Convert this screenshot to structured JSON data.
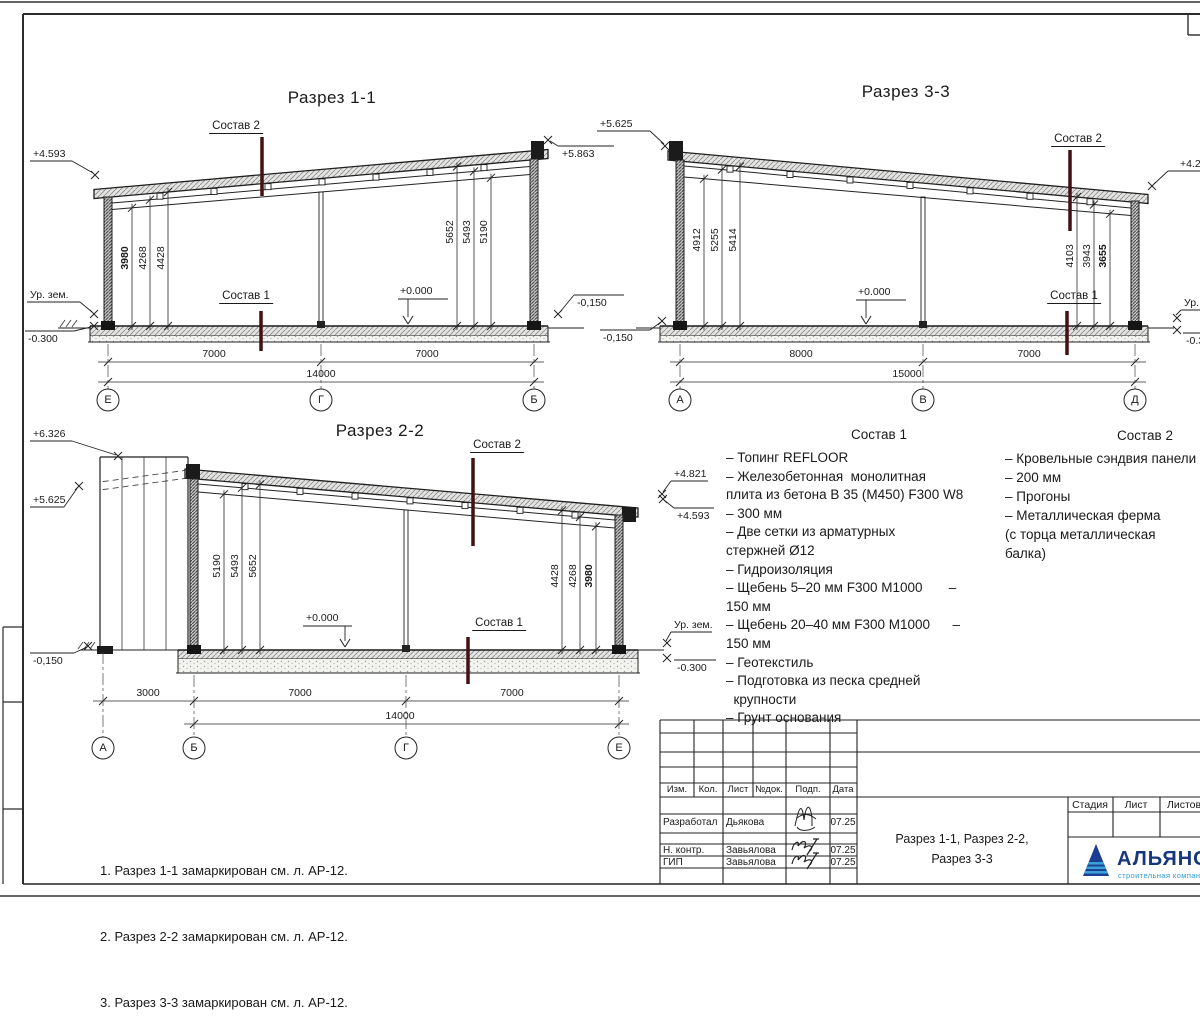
{
  "sections": {
    "s1": {
      "title": "Разрез 1-1",
      "sostav2": "Состав 2",
      "sostav1": "Состав 1",
      "elevs": {
        "left_top": "+4.593",
        "ground": "Ур. зем.",
        "left_bottom": "-0.300",
        "right_top": "+5.863",
        "right_bottom": "-0,150",
        "zero": "+0.000"
      },
      "dims_left": [
        "3980",
        "4268",
        "4428"
      ],
      "dims_right": [
        "5652",
        "5493",
        "5190"
      ],
      "spans": [
        "7000",
        "7000"
      ],
      "total": "14000",
      "axes": [
        "Е",
        "Г",
        "Б"
      ]
    },
    "s3": {
      "title": "Разрез 3-3",
      "sostav2": "Состав 2",
      "sostav1": "Состав 1",
      "elevs": {
        "left_top": "+5.625",
        "left_bottom": "-0,150",
        "right_top": "+4.2",
        "right_ground": "Ур.",
        "right_bottom": "-0.3",
        "zero": "+0.000"
      },
      "dims_left": [
        "4912",
        "5255",
        "5414"
      ],
      "dims_right": [
        "4103",
        "3943",
        "3655"
      ],
      "spans": [
        "8000",
        "7000"
      ],
      "total": "15000",
      "axes": [
        "А",
        "В",
        "Д"
      ]
    },
    "s2": {
      "title": "Разрез 2-2",
      "sostav2": "Состав 2",
      "sostav1": "Состав 1",
      "elevs": {
        "left_top": "+6.326",
        "left_mid": "+5.625",
        "left_bottom": "-0,150",
        "right_top": "+4.821",
        "right_mid": "+4.593",
        "right_ground": "Ур. зем.",
        "right_bottom": "-0.300",
        "zero": "+0.000"
      },
      "dims_left": [
        "5190",
        "5493",
        "5652"
      ],
      "dims_right": [
        "4428",
        "4268",
        "3980"
      ],
      "spans": [
        "3000",
        "7000",
        "7000"
      ],
      "total": "14000",
      "axes": [
        "А",
        "Б",
        "Г",
        "Е"
      ]
    }
  },
  "composition1": {
    "title": "Состав 1",
    "lines": [
      "– Топинг REFLOOR",
      "– Железобетонная  монолитная",
      "плита из бетона В 35 (М450) F300 W8",
      "– 300 мм",
      "– Две сетки из арматурных",
      "стержней Ø12",
      "– Гидроизоляция",
      "– Щебень 5–20 мм F300 М1000       –",
      "150 мм",
      "– Щебень 20–40 мм F300 М1000      –",
      "150 мм",
      "– Геотекстиль",
      "– Подготовка из песка средней",
      "  крупности",
      "– Грунт основания"
    ]
  },
  "composition2": {
    "title": "Состав 2",
    "lines": [
      "– Кровельные сэндвия панели",
      "– 200 мм",
      "– Прогоны",
      "– Металлическая ферма",
      "(с торца металлическая",
      "балка)"
    ]
  },
  "notes": [
    "1. Разрез 1-1 замаркирован см. л. АР-12.",
    "2. Разрез 2-2 замаркирован см. л. АР-12.",
    "3. Разрез 3-3 замаркирован см. л. АР-12."
  ],
  "title_block": {
    "header_cols": [
      "Изм.",
      "Кол.",
      "Лист",
      "№док.",
      "Подп.",
      "Дата"
    ],
    "rows": [
      {
        "role": "Разработал",
        "name": "Дьякова",
        "date": "07.25"
      },
      {
        "role": "Н. контр.",
        "name": "Завьялова",
        "date": "07.25"
      },
      {
        "role": "ГИП",
        "name": "Завьялова",
        "date": "07.25"
      }
    ],
    "doc_title": [
      "Разрез 1-1, Разрез 2-2,",
      "Разрез 3-3"
    ],
    "stage_cols": [
      "Стадия",
      "Лист",
      "Листов"
    ],
    "logo": {
      "name": "АЛЬЯНС",
      "tagline": "строительная компания"
    }
  },
  "colors": {
    "marker": "#451013",
    "logo_dark": "#16367d",
    "logo_light": "#2e9ad6"
  }
}
